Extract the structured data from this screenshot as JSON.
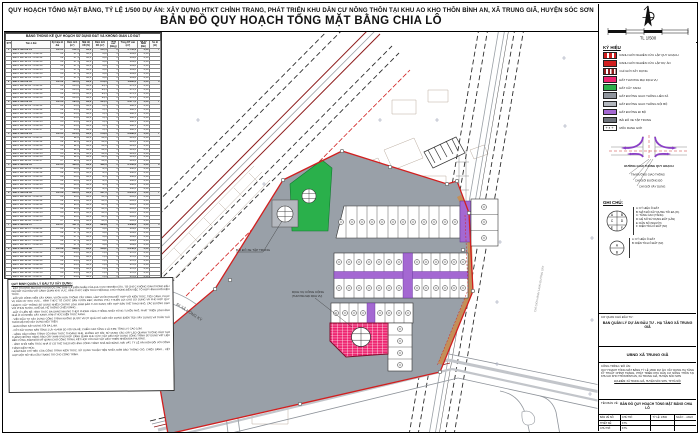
{
  "page": {
    "title_line1": "QUY HOẠCH TỔNG MẶT BẰNG, TỶ LỆ 1/500 DỰ ÁN: XÂY DỰNG HTKT CHỈNH TRANG, PHÁT TRIỂN KHU DÂN CƯ NÔNG THÔN TẠI KHU AO KHO THÔN BÌNH AN, XÃ TRUNG GIÃ, HUYỆN SÓC SƠN",
    "title_line2": "BẢN ĐỒ QUY HOẠCH TỔNG MẶT BẰNG CHIA LÔ"
  },
  "colors": {
    "boundary": "#d11f1f",
    "road": "#99a0a8",
    "green": "#2ab04b",
    "commercial": "#ee2470",
    "walkway": "#a468d2",
    "dark_red_edge": "#8e1c1c"
  },
  "table": {
    "title": "BẢNG THỐNG KÊ QUY HOẠCH SỬ DỤNG ĐẤT VÀ KHÔNG GIAN LÔ ĐẤT",
    "headers": [
      "STT",
      "Tên ô đất",
      "Ký hiệu lô đất",
      "Diện tích (m²)",
      "Mật độ XD (%)",
      "Diện tích XD (m²)",
      "Tầng cao (tầng)",
      "Tổng DT sàn (m²)",
      "Hệ số SDĐ (lần)",
      "Số lô (lô)"
    ],
    "rows": [
      {
        "cls": "g",
        "c": [
          "1",
          "Đất ở liền kề 01",
          "LK-01",
          "612,5",
          "90,0",
          "551,3",
          "5",
          "2.756,3",
          "4,50",
          "7"
        ]
      },
      {
        "c": [
          "",
          "Đất ở liền kề 01 - lô số 01",
          "01",
          "87,5",
          "90,0",
          "78,8",
          "5",
          "393,8",
          "4,50",
          ""
        ]
      },
      {
        "c": [
          "",
          "Đất ở liền kề 01 - lô số 02",
          "02",
          "87,5",
          "90,0",
          "78,8",
          "5",
          "393,8",
          "4,50",
          ""
        ]
      },
      {
        "c": [
          "",
          "Đất ở liền kề 01 - lô số 03",
          "03",
          "87,5",
          "90,0",
          "78,8",
          "5",
          "393,8",
          "4,50",
          ""
        ]
      },
      {
        "c": [
          "",
          "Đất ở liền kề 01 - lô số 04",
          "04",
          "87,5",
          "90,0",
          "78,8",
          "5",
          "393,8",
          "4,50",
          ""
        ]
      },
      {
        "c": [
          "",
          "Đất ở liền kề 01 - lô số 05",
          "05",
          "87,5",
          "90,0",
          "78,8",
          "5",
          "393,8",
          "4,50",
          ""
        ]
      },
      {
        "c": [
          "",
          "Đất ở liền kề 01 - lô số 06",
          "06",
          "87,5",
          "90,0",
          "78,8",
          "5",
          "393,8",
          "4,50",
          ""
        ]
      },
      {
        "c": [
          "",
          "Đất ở liền kề 01 - lô số 07",
          "07",
          "87,5",
          "90,0",
          "78,8",
          "5",
          "393,8",
          "4,50",
          ""
        ]
      },
      {
        "cls": "g",
        "c": [
          "2",
          "Đất ở liền kề 02",
          "LK-02",
          "420,0",
          "90,0",
          "378,0",
          "5",
          "1.890,0",
          "4,50",
          "4"
        ]
      },
      {
        "c": [
          "",
          "Đất ở liền kề 02 - lô số 01",
          "01",
          "105,0",
          "90,0",
          "94,5",
          "5",
          "472,5",
          "4,50",
          ""
        ]
      },
      {
        "c": [
          "",
          "Đất ở liền kề 02 - lô số 02",
          "02",
          "105,0",
          "90,0",
          "94,5",
          "5",
          "472,5",
          "4,50",
          ""
        ]
      },
      {
        "c": [
          "",
          "Đất ở liền kề 02 - lô số 03",
          "03",
          "105,0",
          "90,0",
          "94,5",
          "5",
          "472,5",
          "4,50",
          ""
        ]
      },
      {
        "c": [
          "",
          "Đất ở liền kề 02 - lô số 04",
          "04",
          "105,0",
          "90,0",
          "94,5",
          "5",
          "472,5",
          "4,50",
          ""
        ]
      },
      {
        "cls": "g",
        "c": [
          "3",
          "Đất ở liền kề 03",
          "LK-03",
          "595,0",
          "90,0",
          "535,5",
          "5",
          "2.677,5",
          "4,50",
          "7"
        ]
      },
      {
        "c": [
          "",
          "Đất ở liền kề 03 - lô số 01",
          "01",
          "85,0",
          "90,0",
          "76,5",
          "5",
          "382,5",
          "4,50",
          ""
        ]
      },
      {
        "c": [
          "",
          "Đất ở liền kề 03 - lô số 02",
          "02",
          "85,0",
          "90,0",
          "76,5",
          "5",
          "382,5",
          "4,50",
          ""
        ]
      },
      {
        "c": [
          "",
          "Đất ở liền kề 03 - lô số 03",
          "03",
          "85,0",
          "90,0",
          "76,5",
          "5",
          "382,5",
          "4,50",
          ""
        ]
      },
      {
        "c": [
          "",
          "Đất ở liền kề 03 - lô số 04",
          "04",
          "85,0",
          "90,0",
          "76,5",
          "5",
          "382,5",
          "4,50",
          ""
        ]
      },
      {
        "c": [
          "",
          "Đất ở liền kề 03 - lô số 05",
          "05",
          "85,0",
          "90,0",
          "76,5",
          "5",
          "382,5",
          "4,50",
          ""
        ]
      },
      {
        "c": [
          "",
          "Đất ở liền kề 03 - lô số 06",
          "06",
          "85,0",
          "90,0",
          "76,5",
          "5",
          "382,5",
          "4,50",
          ""
        ]
      },
      {
        "c": [
          "",
          "Đất ở liền kề 03 - lô số 07",
          "07",
          "85,0",
          "90,0",
          "76,5",
          "5",
          "382,5",
          "4,50",
          ""
        ]
      },
      {
        "cls": "g",
        "c": [
          "4",
          "Đất ở liền kề 04",
          "LK-04",
          "644,0",
          "90,0",
          "579,6",
          "5",
          "2.898,0",
          "4,50",
          "7"
        ]
      },
      {
        "c": [
          "",
          "Đất ở liền kề 04 - lô số 01",
          "01",
          "92,0",
          "90,0",
          "82,8",
          "5",
          "414,0",
          "4,50",
          ""
        ]
      },
      {
        "c": [
          "",
          "Đất ở liền kề 04 - lô số 02",
          "02",
          "92,0",
          "90,0",
          "82,8",
          "5",
          "414,0",
          "4,50",
          ""
        ]
      },
      {
        "c": [
          "",
          "Đất ở liền kề 04 - lô số 03",
          "03",
          "92,0",
          "90,0",
          "82,8",
          "5",
          "414,0",
          "4,50",
          ""
        ]
      },
      {
        "c": [
          "",
          "Đất ở liền kề 04 - lô số 04",
          "04",
          "92,0",
          "90,0",
          "82,8",
          "5",
          "414,0",
          "4,50",
          ""
        ]
      },
      {
        "c": [
          "",
          "Đất ở liền kề 04 - lô số 05",
          "05",
          "92,0",
          "90,0",
          "82,8",
          "5",
          "414,0",
          "4,50",
          ""
        ]
      },
      {
        "c": [
          "",
          "Đất ở liền kề 04 - lô số 06",
          "06",
          "92,0",
          "90,0",
          "82,8",
          "5",
          "414,0",
          "4,50",
          ""
        ]
      },
      {
        "c": [
          "",
          "Đất ở liền kề 04 - lô số 07",
          "07",
          "92,0",
          "90,0",
          "82,8",
          "5",
          "414,0",
          "4,50",
          ""
        ]
      },
      {
        "cls": "g",
        "c": [
          "5",
          "Đất ở liền kề 05",
          "LK-05",
          "480,0",
          "90,0",
          "432,0",
          "5",
          "2.160,0",
          "4,50",
          "6"
        ]
      },
      {
        "c": [
          "",
          "Đất ở liền kề 05 - lô số 01",
          "01",
          "80,0",
          "90,0",
          "72,0",
          "5",
          "360,0",
          "4,50",
          ""
        ]
      },
      {
        "c": [
          "",
          "Đất ở liền kề 05 - lô số 02",
          "02",
          "80,0",
          "90,0",
          "72,0",
          "5",
          "360,0",
          "4,50",
          ""
        ]
      },
      {
        "c": [
          "",
          "Đất ở liền kề 05 - lô số 03",
          "03",
          "80,0",
          "90,0",
          "72,0",
          "5",
          "360,0",
          "4,50",
          ""
        ]
      },
      {
        "c": [
          "",
          "Đất ở liền kề 05 - lô số 04",
          "04",
          "80,0",
          "90,0",
          "72,0",
          "5",
          "360,0",
          "4,50",
          ""
        ]
      },
      {
        "c": [
          "",
          "Đất ở liền kề 05 - lô số 05",
          "05",
          "80,0",
          "90,0",
          "72,0",
          "5",
          "360,0",
          "4,50",
          ""
        ]
      },
      {
        "c": [
          "",
          "Đất ở liền kề 05 - lô số 06",
          "06",
          "80,0",
          "90,0",
          "72,0",
          "5",
          "360,0",
          "4,50",
          ""
        ]
      },
      {
        "cls": "g",
        "c": [
          "6",
          "Đất ở liền kề 06",
          "LK-06",
          "630,0",
          "90,0",
          "567,0",
          "5",
          "2.835,0",
          "4,50",
          "7"
        ]
      },
      {
        "c": [
          "",
          "Đất ở liền kề 06 - lô số 01",
          "01",
          "90,0",
          "90,0",
          "81,0",
          "5",
          "405,0",
          "4,50",
          ""
        ]
      },
      {
        "c": [
          "",
          "Đất ở liền kề 06 - lô số 02",
          "02",
          "90,0",
          "90,0",
          "81,0",
          "5",
          "405,0",
          "4,50",
          ""
        ]
      },
      {
        "c": [
          "",
          "Đất ở liền kề 06 - lô số 03",
          "03",
          "90,0",
          "90,0",
          "81,0",
          "5",
          "405,0",
          "4,50",
          ""
        ]
      },
      {
        "c": [
          "",
          "Đất ở liền kề 06 - lô số 04",
          "04",
          "90,0",
          "90,0",
          "81,0",
          "5",
          "405,0",
          "4,50",
          ""
        ]
      },
      {
        "c": [
          "",
          "Đất ở liền kề 06 - lô số 05",
          "05",
          "90,0",
          "90,0",
          "81,0",
          "5",
          "405,0",
          "4,50",
          ""
        ]
      },
      {
        "c": [
          "",
          "Đất ở liền kề 06 - lô số 06",
          "06",
          "90,0",
          "90,0",
          "81,0",
          "5",
          "405,0",
          "4,50",
          ""
        ]
      },
      {
        "c": [
          "",
          "Đất ở liền kề 06 - lô số 07",
          "07",
          "90,0",
          "90,0",
          "81,0",
          "5",
          "405,0",
          "4,50",
          ""
        ]
      },
      {
        "cls": "g",
        "c": [
          "7",
          "Đất ở liền kề 07",
          "LK-07",
          "437,5",
          "90,0",
          "393,8",
          "5",
          "1.968,8",
          "4,50",
          "5"
        ]
      },
      {
        "c": [
          "",
          "Đất ở liền kề 07 - lô số 01",
          "01",
          "87,5",
          "90,0",
          "78,8",
          "5",
          "393,8",
          "4,50",
          ""
        ]
      },
      {
        "c": [
          "",
          "Đất ở liền kề 07 - lô số 02",
          "02",
          "87,5",
          "90,0",
          "78,8",
          "5",
          "393,8",
          "4,50",
          ""
        ]
      },
      {
        "c": [
          "",
          "Đất ở liền kề 07 - lô số 03",
          "03",
          "87,5",
          "90,0",
          "78,8",
          "5",
          "393,8",
          "4,50",
          ""
        ]
      },
      {
        "c": [
          "",
          "Đất ở liền kề 07 - lô số 04",
          "04",
          "87,5",
          "90,0",
          "78,8",
          "5",
          "393,8",
          "4,50",
          ""
        ]
      },
      {
        "c": [
          "",
          "Đất ở liền kề 07 - lô số 05",
          "05",
          "87,5",
          "90,0",
          "78,8",
          "5",
          "393,8",
          "4,50",
          ""
        ]
      },
      {
        "cls": "g",
        "c": [
          "8",
          "Đất ở liền kề 08",
          "LK-08",
          "588,0",
          "90,0",
          "529,2",
          "5",
          "2.646,0",
          "4,50",
          "7"
        ]
      },
      {
        "c": [
          "",
          "Đất ở liền kề 08 - lô số 01",
          "01",
          "84,0",
          "90,0",
          "75,6",
          "5",
          "378,0",
          "4,50",
          ""
        ]
      },
      {
        "c": [
          "",
          "Đất ở liền kề 08 - lô số 02",
          "02",
          "84,0",
          "90,0",
          "75,6",
          "5",
          "378,0",
          "4,50",
          ""
        ]
      },
      {
        "c": [
          "",
          "Đất ở liền kề 08 - lô số 03",
          "03",
          "84,0",
          "90,0",
          "75,6",
          "5",
          "378,0",
          "4,50",
          ""
        ]
      },
      {
        "c": [
          "",
          "Đất ở liền kề 08 - lô số 04",
          "04",
          "84,0",
          "90,0",
          "75,6",
          "5",
          "378,0",
          "4,50",
          ""
        ]
      },
      {
        "c": [
          "",
          "Đất ở liền kề 08 - lô số 05",
          "05",
          "84,0",
          "90,0",
          "75,6",
          "5",
          "378,0",
          "4,50",
          ""
        ]
      },
      {
        "c": [
          "",
          "Đất ở liền kề 08 - lô số 06",
          "06",
          "84,0",
          "90,0",
          "75,6",
          "5",
          "378,0",
          "4,50",
          ""
        ]
      },
      {
        "c": [
          "",
          "Đất ở liền kề 08 - lô số 07",
          "07",
          "84,0",
          "90,0",
          "75,6",
          "5",
          "378,0",
          "4,50",
          ""
        ]
      },
      {
        "cls": "t",
        "c": [
          "",
          "Tổng",
          "",
          "4.407,0",
          "",
          "3.966,4",
          "",
          "19.831,6",
          "",
          "50"
        ]
      }
    ]
  },
  "notes": {
    "heading": "QUY ĐỊNH QUẢN LÝ ĐẦU TƯ XÂY DỰNG:",
    "paragraphs": [
      "- ĐẤT THƯƠNG MẠI DỊCH VỤ ĐƯỢC XÁC ĐỊNH LÀ ĐIỂM NHẤN CỦA KHU VỰC NGHIÊN CỨU, TỔ CHỨC KHÔNG GIAN TRONG ĐẤU GIÁ ĐẤT HÀI HÒA VỚI CẢNH QUAN KHU VỰC, HÌNH THỨC KIẾN TRÚC HIỆN ĐẠI, CHÚ TRỌNG ĐẾN VIỆC TỔ HỢP HÌNH KHỐI KIẾN TRÚC.",
      "- ĐỐI VỚI CÔNG VIÊN CÂY XANH, VƯỜN HOA: TRỒNG CÂY XANH, LÀM VƯỜN HOA KẾT HỢP VỚI KIẾN TRÚC, TIỂU CẢNH, PHỤC VỤ DÂN CƯ KHU VỰC... HÌNH THỨC TỔ CHỨC SÂN VƯỜN ĐẸP, PHONG PHÚ, THUẬN LỢI CHO SỬ DỤNG VÀ PHÙ HỢP QUY HOẠCH; CÂY TRỒNG SỬ DỤNG NHIỀU CHỦNG LOẠI, ĐẢM BẢO TƯƠI XANH; KẾT HỢP SÂN THỂ THAO NHỎ, CÁC ĐƯỜNG DẠO VỚI PHUN NƯỚC, GHẾ ĐÁ, HỆ THỐNG CHIẾU SÁNG...",
      "- ĐẤT Ở LIỀN KỀ: HÌNH THỨC ĐA DẠNG NHƯNG THEO PHONG CÁCH THỐNG NHẤT TỪNG TUYẾN PHỐ, PHÁT TRIỂN LOẠI HÌNH NHÀ Ở CÓ NHIỀU CÂY XANH, HÌNH THỨC KIẾN TRÚC XANH.",
      "- VIỆC ĐẦU TƯ XÂY DỰNG CÔNG TRÌNH KHÔNG ĐƯỢC VƯỢT QUÁ CHỈ GIỚI XÂY DỰNG (DIỆN TÍCH XÂY DỰNG) VÀ TUÂN THỦ THEO MẬT ĐỘ XÂY DỰNG NÊU TRÊN.",
      "- BAN CÔNG XÂY DỰNG TỐI ĐA 1,4M.",
      "- CỐT XÂY DỰNG SÀN TẦNG 1 LÀ +0,45M SO VỚI VỈA HÈ; CHIỀU CAO TẦNG 1 LÀ 3,9M; TẦNG 2-5 CAO 3,3M.",
      "- HÀNG RÀO CÔNG TRÌNH CÓ HÌNH THỨC THOÁNG NHẸ, KHÔNG BỊT KÍN; SỬ DỤNG CÁC CÂY LEO QUANH TƯỜNG RÀO TẠO THÀNH NHỮNG HÀNG RÀO CÂY XANH PHÙ HỢP CẢNH QUAN KHU VỰC; VẬT LIỆU XÂY DỰNG CÔNG TRÌNH SỬ DỤNG VẬT LIỆU BỀN VỮNG, ĐẢM BẢO MỸ QUAN CHO CÔNG TRÌNH, KẾT HỢP VỚI CÁC VẬT LIỆU THIÊN NHIÊN ĐỊA PHƯƠNG.",
      "- HÌNH KHỐI KIẾN TRÚC NHÀ Ở CÓ THỂ THEO MÔ HÌNH CÔNG TRÌNH NHÀ MÁI BẰNG, MÁI VÁT, TỶ LỆ HÀI HÒA ĐỐI VỚI CÔNG TRÌNH KIẾN TRÚC.",
      "- ĐẢM BẢO CHỈ TIÊU CỦA CÔNG TRÌNH KIẾN TRÚC, SỬ DỤNG THUẬN TIỆN NHẤT, ĐẢM BẢO THÔNG GIÓ, CHIẾU SÁNG... KẾT HỢP MỘT SỐ YÊU CẦU TRANG TRÍ CHO CÔNG TRÌNH."
    ]
  },
  "legend": {
    "title": "KÝ HIỆU",
    "items": [
      {
        "label": "RANH GIỚI NGHIÊN CỨU LẬP QUY HOẠCH",
        "pattern": "sw-dashred"
      },
      {
        "label": "RANH GIỚI NGHIÊN CỨU LẬP DỰ ÁN",
        "pattern": "sw-solidred"
      },
      {
        "label": "CHỈ GIỚI XÂY DỰNG",
        "pattern": "sw-dashdarkred"
      },
      {
        "label": "ĐẤT THƯƠNG MẠI DỊCH VỤ",
        "color": "#ee2470"
      },
      {
        "label": "ĐẤT CÂY XANH",
        "color": "#2ab04b"
      },
      {
        "label": "ĐẤT ĐƯỜNG GIAO THÔNG LIÊN XÃ",
        "color": "#8f949c"
      },
      {
        "label": "ĐẤT ĐƯỜNG GIAO THÔNG NỘI BỘ",
        "color": "#b2b6bd"
      },
      {
        "label": "ĐẤT ĐƯỜNG ĐI BỘ",
        "color": "#a468d2"
      },
      {
        "label": "BÃI ĐỖ XE TẬP TRUNG",
        "color": "#6f747c"
      },
      {
        "label": "MỐC RANH GIỚI",
        "pattern": "sw-moc"
      }
    ]
  },
  "junction": {
    "title": "ĐƯỜNG GIAO THÔNG QUY HOẠCH",
    "lines": [
      "TIM ĐƯỜNG GIAO THÔNG",
      "CHỈ GIỚI ĐƯỜNG ĐỎ",
      "CHỈ GIỚI XÂY DỰNG"
    ]
  },
  "ghichu": {
    "title": "GHI CHÚ:",
    "letters1": [
      "A",
      "B",
      "C",
      "D",
      "E",
      "F"
    ],
    "letters2": [
      "A",
      "B"
    ],
    "circle1": [
      "A: KÝ HIỆU Ô ĐẤT",
      "B: MẬT ĐỘ XÂY DỰNG TỐI ĐA (%)",
      "C: TẦNG CAO (TẦNG)",
      "D: HỆ SỐ SỬ DỤNG ĐẤT (LẦN)",
      "E: DÂN SỐ (NGƯỜI)",
      "F: DIỆN TÍCH Ô ĐẤT (M²)"
    ],
    "circle2": [
      "A: KÝ HIỆU Ô ĐẤT",
      "B: DIỆN TÍCH Ô ĐẤT (M²)"
    ]
  },
  "titleblock": {
    "investor_label": "CƠ QUAN CHỦ ĐẦU TƯ:",
    "investor": "BAN QUẢN LÝ DỰ ÁN ĐẦU TƯ - HẠ TẦNG XÃ TRUNG GIÃ",
    "agency": "UBND XÃ TRUNG GIÃ",
    "project_label": "CÔNG TRÌNH / ĐỒ ÁN:",
    "project": "QUY HOẠCH TỔNG MẶT BẰNG TỶ LỆ 1/500 DỰ ÁN: XÂY DỰNG HẠ TẦNG KỸ THUẬT CHỈNH TRANG, PHÁT TRIỂN KHU DÂN CƯ NÔNG THÔN TẠI KHU AO KHO THÔN BÌNH AN, XÃ TRUNG GIÃ, HUYỆN SÓC SƠN",
    "location": "ĐỊA ĐIỂM: XÃ TRUNG GIÃ, HUYỆN SÓC SƠN, TP HÀ NỘI",
    "drawing_label": "TÊN BẢN VẼ:",
    "drawing": "BẢN ĐỒ QUY HOẠCH TỔNG MẶT BẰNG CHIA LÔ",
    "grid": [
      [
        "BẢN VẼ SỐ:",
        "CHỦ TRÌ:",
        "TỶ LỆ: 1/500",
        "NGÀY: .../2023"
      ],
      [
        "THIẾT KẾ:",
        "KTS.",
        "",
        ""
      ],
      [
        "CHỦ TRÌ:",
        "KTS.",
        "",
        ""
      ]
    ]
  },
  "map": {
    "scale_label": "TL 1/500",
    "road_label": "ĐI XÃ HỒNG KỲ",
    "parking_label": "BÃI ĐỖ XE TẬP TRUNG",
    "commercial_label": "DỊCH VỤ CÔNG CỘNG",
    "commercial_sub": "(THƯƠNG MẠI DỊCH VỤ)",
    "rail_label": "CHỈ GIỚI HÀNH LANG ĐƯỜNG SẮT"
  }
}
